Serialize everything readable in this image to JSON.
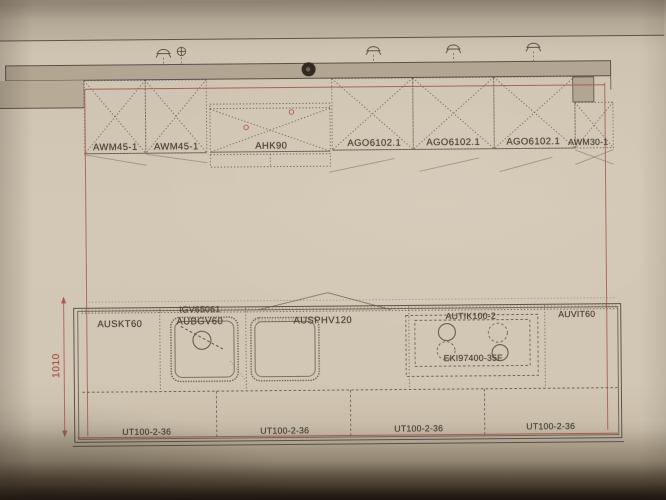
{
  "document": {
    "kind_note": "kitchen elevation plan photograph",
    "colors": {
      "paper": "#d2c6b4",
      "line": "#5d5347",
      "construction_red": "#a8554a",
      "soffit_fill": "#b2a692",
      "label_text": "#4a4238"
    },
    "icons": {
      "ceiling_light_icon": "arc-with-legs glyph",
      "junction_box_icon": "circle-with-cross glyph",
      "punch_hole_icon": "filled dark circle"
    }
  },
  "wall_units": [
    {
      "label": "AWM45-1"
    },
    {
      "label": "AWM45-1"
    },
    {
      "label": "AHK90"
    },
    {
      "label": "AGO6102.1"
    },
    {
      "label": "AGO6102.1"
    },
    {
      "label": "AGO6102.1"
    },
    {
      "label": "AWM30-1"
    }
  ],
  "base": {
    "cabinets": [
      {
        "label": "AUSKT60"
      },
      {
        "label": "AUBGV60"
      },
      {
        "label": "AUSPHV120"
      },
      {
        "label": "AUTIK100-2"
      },
      {
        "label": "AUVIT60"
      }
    ],
    "appliances": [
      {
        "label": "IGV65061"
      },
      {
        "label": "EKI97400-35F"
      }
    ],
    "drawer_units": [
      {
        "label": "UT100-2-36"
      },
      {
        "label": "UT100-2-36"
      },
      {
        "label": "UT100-2-36"
      },
      {
        "label": "UT100-2-36"
      }
    ]
  },
  "dimension": {
    "value": "1010"
  }
}
